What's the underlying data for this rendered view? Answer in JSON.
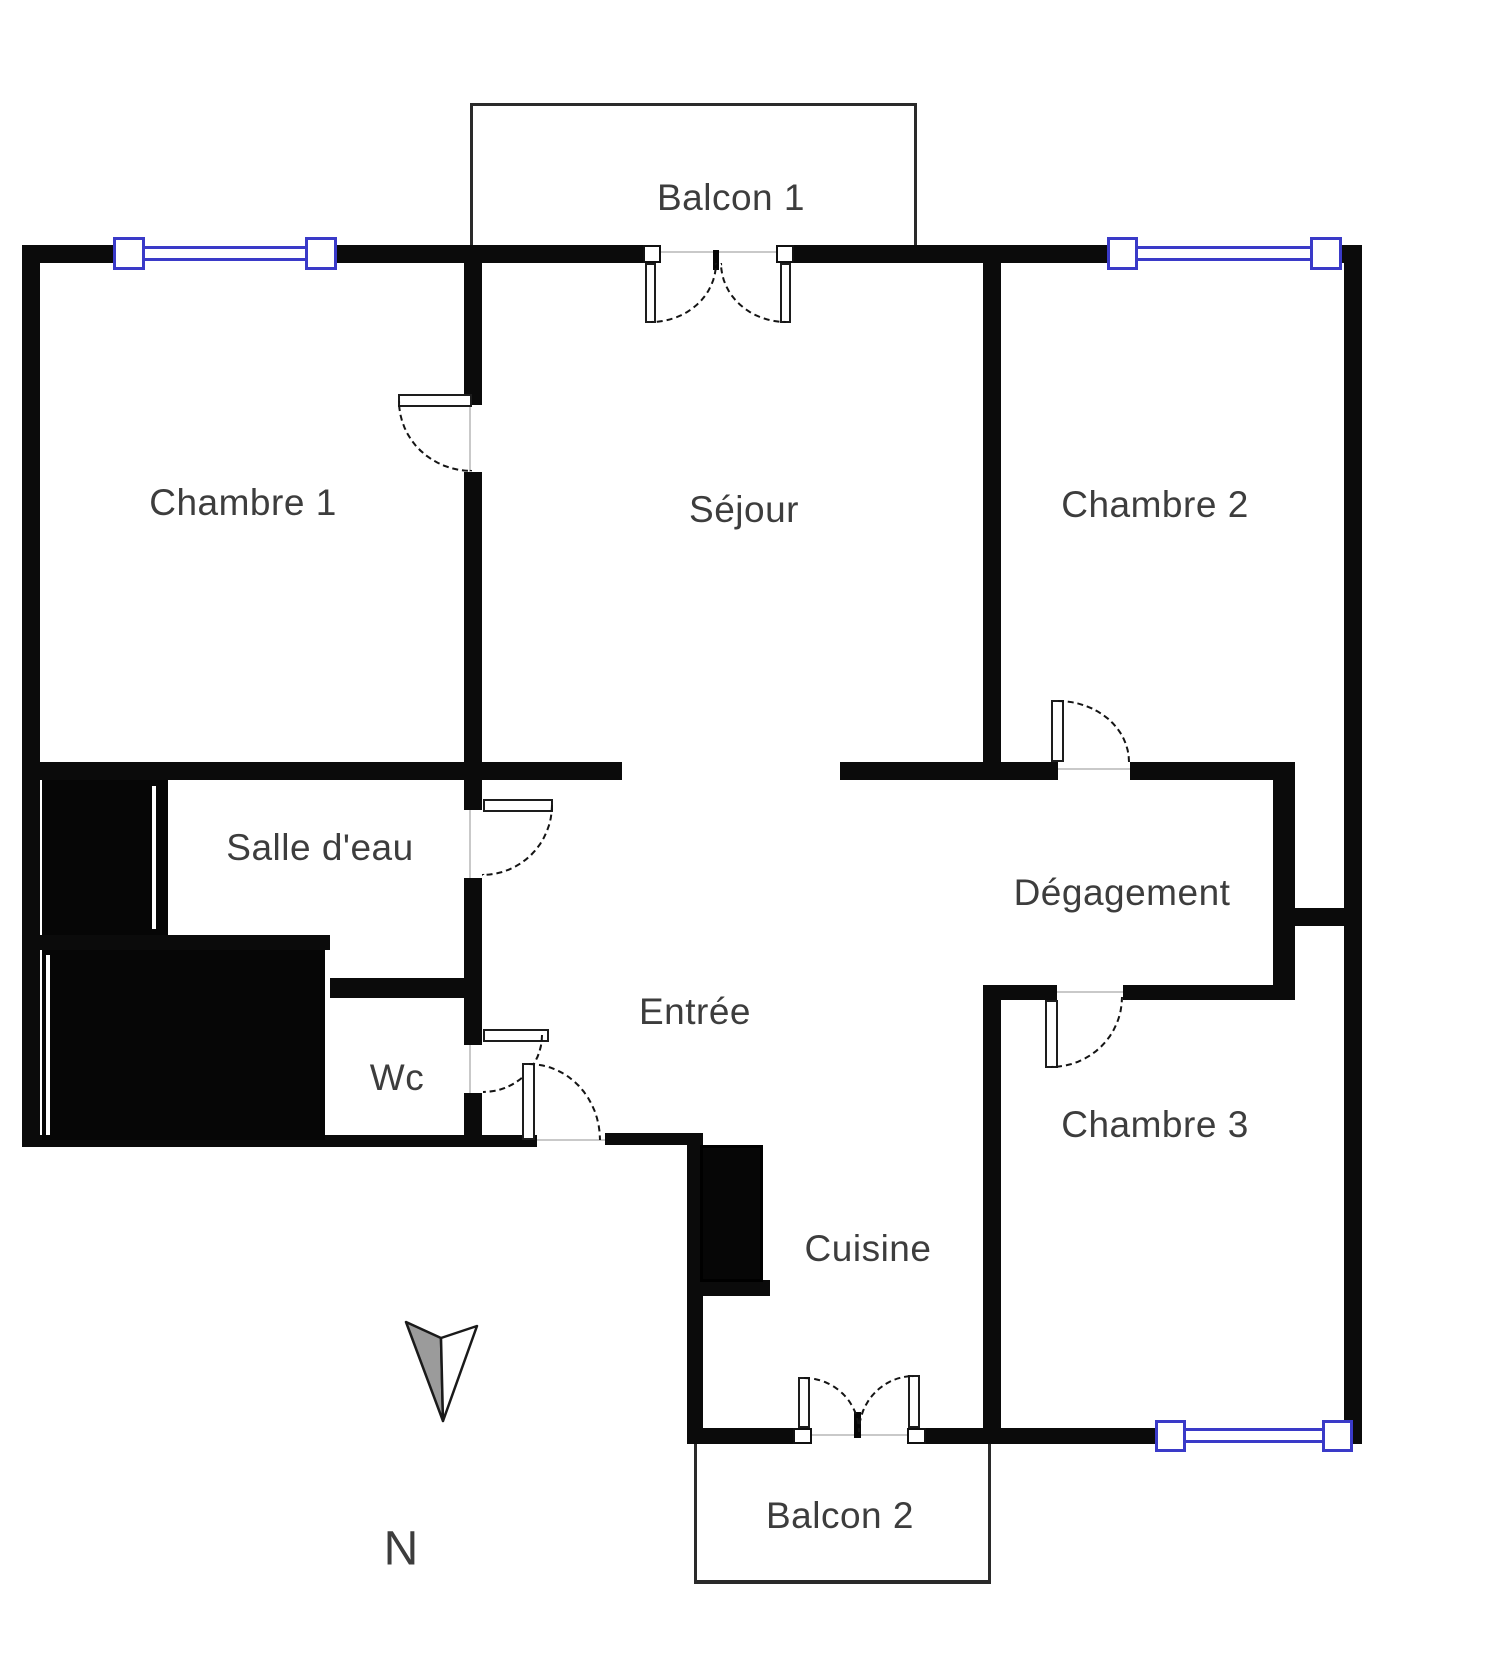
{
  "plan": {
    "title": "Apartment floor plan",
    "colors": {
      "wall": "#0b0b0b",
      "window_frame": "#3a3ac8",
      "text": "#3d3d3d",
      "north_arrow_fill": "#9b9b9b"
    },
    "rooms": {
      "balcon1": {
        "label": "Balcon 1"
      },
      "chambre1": {
        "label": "Chambre 1"
      },
      "sejour": {
        "label": "Séjour"
      },
      "chambre2": {
        "label": "Chambre 2"
      },
      "salle_deau": {
        "label": "Salle d'eau"
      },
      "degagement": {
        "label": "Dégagement"
      },
      "entree": {
        "label": "Entrée"
      },
      "wc": {
        "label": "Wc"
      },
      "cuisine": {
        "label": "Cuisine"
      },
      "chambre3": {
        "label": "Chambre 3"
      },
      "balcon2": {
        "label": "Balcon 2"
      }
    },
    "compass": {
      "north_label": "N"
    }
  }
}
